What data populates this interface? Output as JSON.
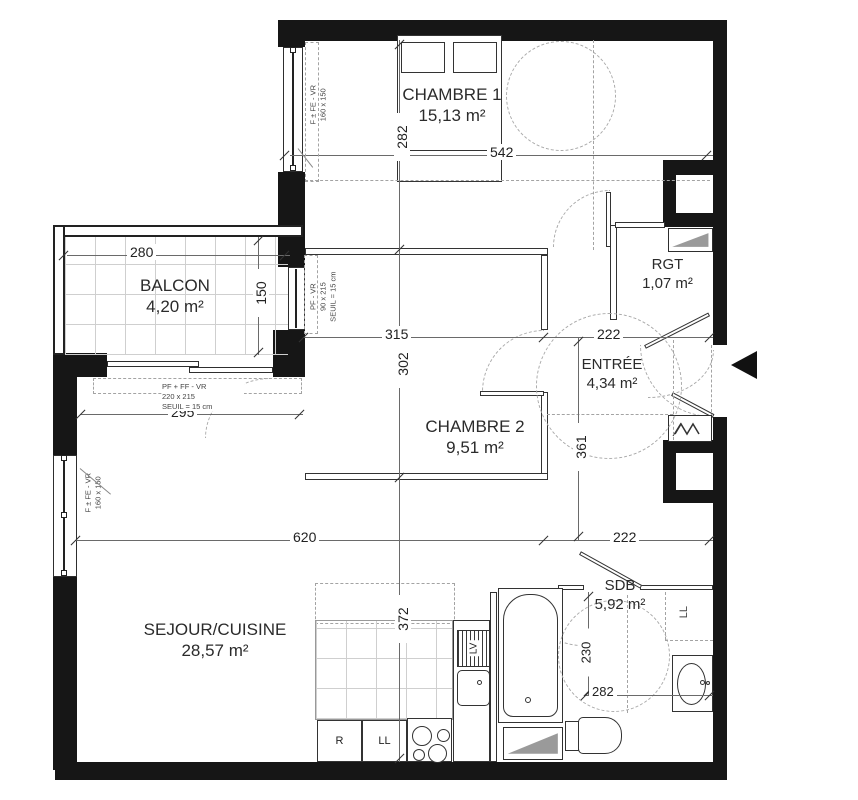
{
  "title": "Plan d'appartement 2 chambres",
  "colors": {
    "wall": "#161616",
    "dim_line": "#6a6a6a",
    "dash": "#a3a3a3",
    "text": "#2b2b2b",
    "fixture_gray": "#9a9a9a"
  },
  "rooms": {
    "chambre1": {
      "name": "CHAMBRE 1",
      "area": "15,13 m²"
    },
    "chambre2": {
      "name": "CHAMBRE 2",
      "area": "9,51 m²"
    },
    "balcon": {
      "name": "BALCON",
      "area": "4,20 m²"
    },
    "rgt": {
      "name": "RGT",
      "area": "1,07 m²"
    },
    "entree": {
      "name": "ENTRÉE",
      "area": "4,34 m²"
    },
    "sejour": {
      "name": "SEJOUR/CUISINE",
      "area": "28,57 m²"
    },
    "sdb": {
      "name": "SDB",
      "area": "5,92 m²"
    }
  },
  "dims": {
    "chambre1_h": "282",
    "chambre1_w": "542",
    "balcon_w": "280",
    "balcon_h": "150",
    "chambre2_w": "315",
    "entree_w": "222",
    "balcony_door_w": "295",
    "chambre2_h": "302",
    "entree_h": "361",
    "sejour_w": "620",
    "sdb_w": "222",
    "sejour_h": "372",
    "sdb_h": "230",
    "sdb_l": "282"
  },
  "windows": {
    "chambre1_window": {
      "l1": "F ± FE - VR",
      "l2": "160 x 150"
    },
    "hall_window": {
      "l1": "PF - VR",
      "l2": "90 x 215",
      "l3": "SEUIL = 15 cm"
    },
    "balcony_door": {
      "l1": "PF + FF - VR",
      "l2": "220 x 215",
      "l3": "SEUIL = 15 cm"
    },
    "sejour_window": {
      "l1": "F ± FE - VR",
      "l2": "160 x 150"
    }
  },
  "appliances": {
    "fridge": "R",
    "washer_kitchen": "LL",
    "dishwasher": "LV",
    "washer_sdb": "LL"
  }
}
